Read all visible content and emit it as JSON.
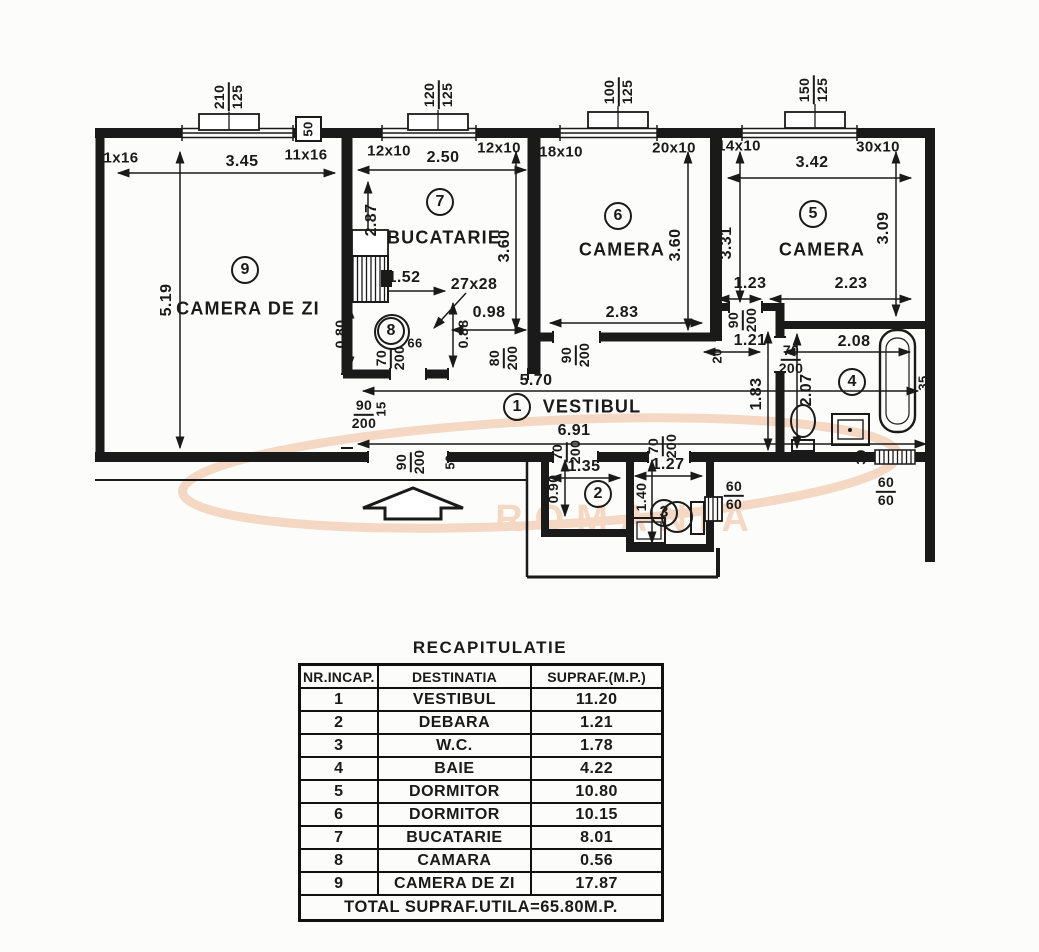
{
  "watermark": {
    "text": "ROMANIA",
    "color": "#f0bb97"
  },
  "plan": {
    "sills": [
      {
        "w": "210",
        "h": "125"
      },
      {
        "w": "120",
        "h": "125"
      },
      {
        "w": "100",
        "h": "125"
      },
      {
        "w": "150",
        "h": "125"
      }
    ],
    "pier_label": "50",
    "windows": [
      "11x16",
      "11x16",
      "12x10",
      "12x10",
      "18x10",
      "20x10",
      "14x10",
      "30x10"
    ],
    "rooms": [
      {
        "num": "9",
        "name": "CAMERA DE ZI"
      },
      {
        "num": "7",
        "name": "BUCATARIE"
      },
      {
        "num": "6",
        "name": "CAMERA"
      },
      {
        "num": "5",
        "name": "CAMERA"
      },
      {
        "num": "1",
        "name": "VESTIBUL"
      },
      {
        "num": "2"
      },
      {
        "num": "3"
      },
      {
        "num": "4"
      },
      {
        "num": "8"
      }
    ],
    "hdims": [
      "3.45",
      "2.50",
      "1.52",
      "27x28",
      "0.98",
      "2.83",
      "3.42",
      "1.23",
      "2.23",
      "1.21",
      "2.08",
      "5.70",
      "6.91",
      "1.35",
      "1.27",
      "66"
    ],
    "vdims": [
      "5.19",
      "2.87",
      "3.60",
      "3.60",
      "3.31",
      "3.09",
      "0.80",
      "0.88",
      "1.83",
      "2.07",
      "0.90",
      "1.40"
    ],
    "small_dims": [
      "15",
      "20",
      "30",
      "35",
      "50"
    ],
    "doors": [
      {
        "w": "90",
        "h": "200"
      },
      {
        "w": "80",
        "h": "200"
      },
      {
        "w": "70",
        "h": "200"
      },
      {
        "w": "90",
        "h": "200"
      },
      {
        "w": "90",
        "h": "200"
      },
      {
        "w": "70",
        "h": "200"
      },
      {
        "w": "90",
        "h": "200"
      },
      {
        "w": "70",
        "h": "200"
      },
      {
        "w": "70",
        "h": "200"
      }
    ],
    "vents": [
      {
        "a": "60",
        "b": "60"
      },
      {
        "a": "60",
        "b": "60"
      }
    ]
  },
  "table": {
    "title": "RECAPITULATIE",
    "headers": [
      "NR.INCAP.",
      "DESTINATIA",
      "SUPRAF.(M.P.)"
    ],
    "rows": [
      [
        "1",
        "VESTIBUL",
        "11.20"
      ],
      [
        "2",
        "DEBARA",
        "1.21"
      ],
      [
        "3",
        "W.C.",
        "1.78"
      ],
      [
        "4",
        "BAIE",
        "4.22"
      ],
      [
        "5",
        "DORMITOR",
        "10.80"
      ],
      [
        "6",
        "DORMITOR",
        "10.15"
      ],
      [
        "7",
        "BUCATARIE",
        "8.01"
      ],
      [
        "8",
        "CAMARA",
        "0.56"
      ],
      [
        "9",
        "CAMERA DE ZI",
        "17.87"
      ]
    ],
    "total": "TOTAL SUPRAF.UTILA=65.80M.P."
  }
}
